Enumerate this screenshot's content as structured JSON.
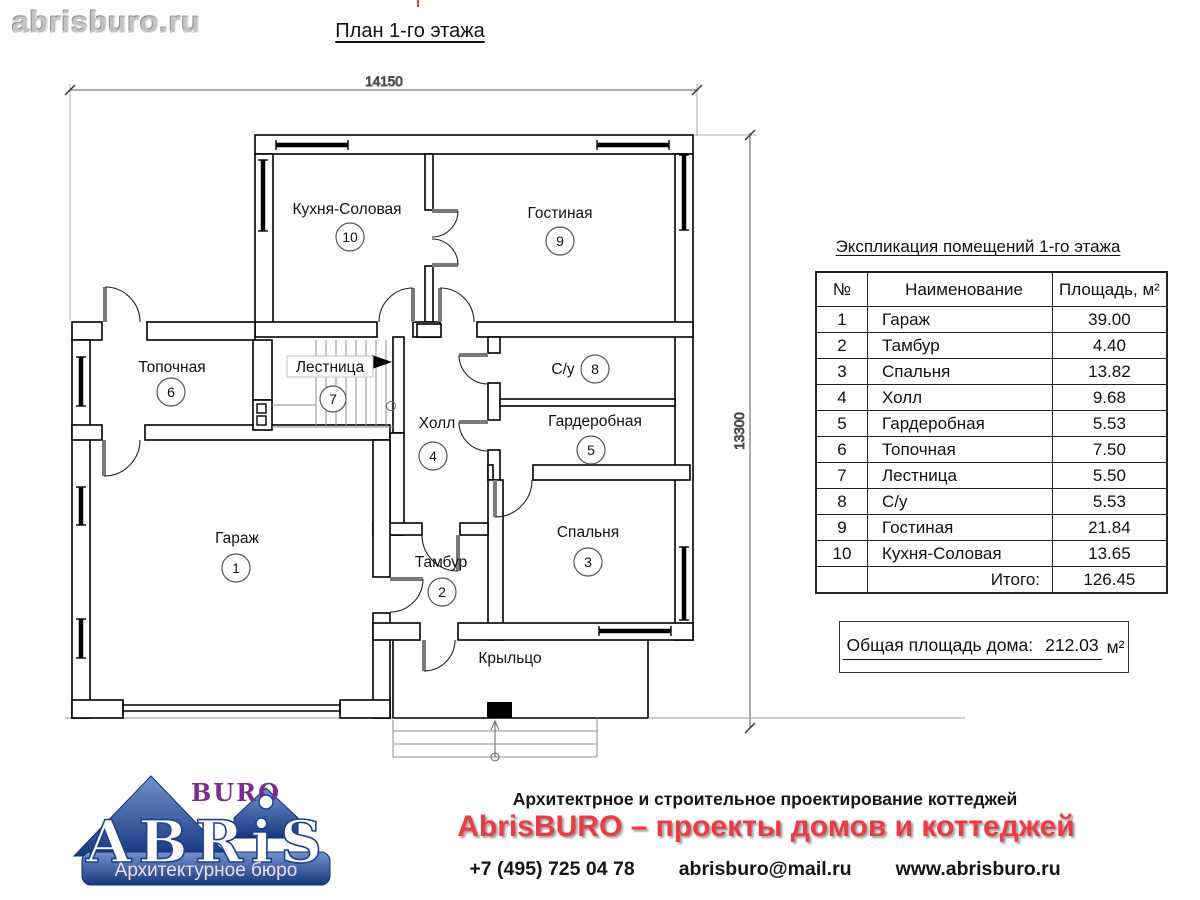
{
  "header": {
    "site": "abrisburo.ru",
    "title": "План 1-го этажа"
  },
  "plan": {
    "dim_width": "14150",
    "dim_height": "13300",
    "porch": "Крыльцо"
  },
  "rooms": [
    {
      "num": "1",
      "name": "Гараж",
      "area": "39.00"
    },
    {
      "num": "2",
      "name": "Тамбур",
      "area": "4.40"
    },
    {
      "num": "3",
      "name": "Спальня",
      "area": "13.82"
    },
    {
      "num": "4",
      "name": "Холл",
      "area": "9.68"
    },
    {
      "num": "5",
      "name": "Гардеробная",
      "area": "5.53"
    },
    {
      "num": "6",
      "name": "Топочная",
      "area": "7.50"
    },
    {
      "num": "7",
      "name": "Лестница",
      "area": "5.50"
    },
    {
      "num": "8",
      "name": "С/у",
      "area": "5.53"
    },
    {
      "num": "9",
      "name": "Гостиная",
      "area": "21.84"
    },
    {
      "num": "10",
      "name": "Кухня-Соловая",
      "area": "13.65"
    }
  ],
  "table": {
    "title": "Экспликация помещений 1-го этажа",
    "col_num": "№",
    "col_name": "Наименование",
    "col_area": "Площадь, м²",
    "total_label": "Итого:",
    "total_value": "126.45"
  },
  "summary": {
    "label": "Общая площадь дома:",
    "value": "212.03",
    "unit": "м²"
  },
  "footer": {
    "logo_buro": "BURO",
    "logo_abris": "ABRiS",
    "logo_sub": "Архитектурное бюро",
    "line1": "Архитектрное и строительное проектирование коттеджей",
    "line2": "AbrisBURO – проекты домов и коттеджей",
    "phone": "+7 (495) 725 04 78",
    "email": "abrisburo@mail.ru",
    "site": "www.abrisburo.ru"
  },
  "colors": {
    "accent_red": "#ee3b43",
    "logo_blue": "#1c3f94",
    "logo_purple": "#7b2d8b"
  }
}
